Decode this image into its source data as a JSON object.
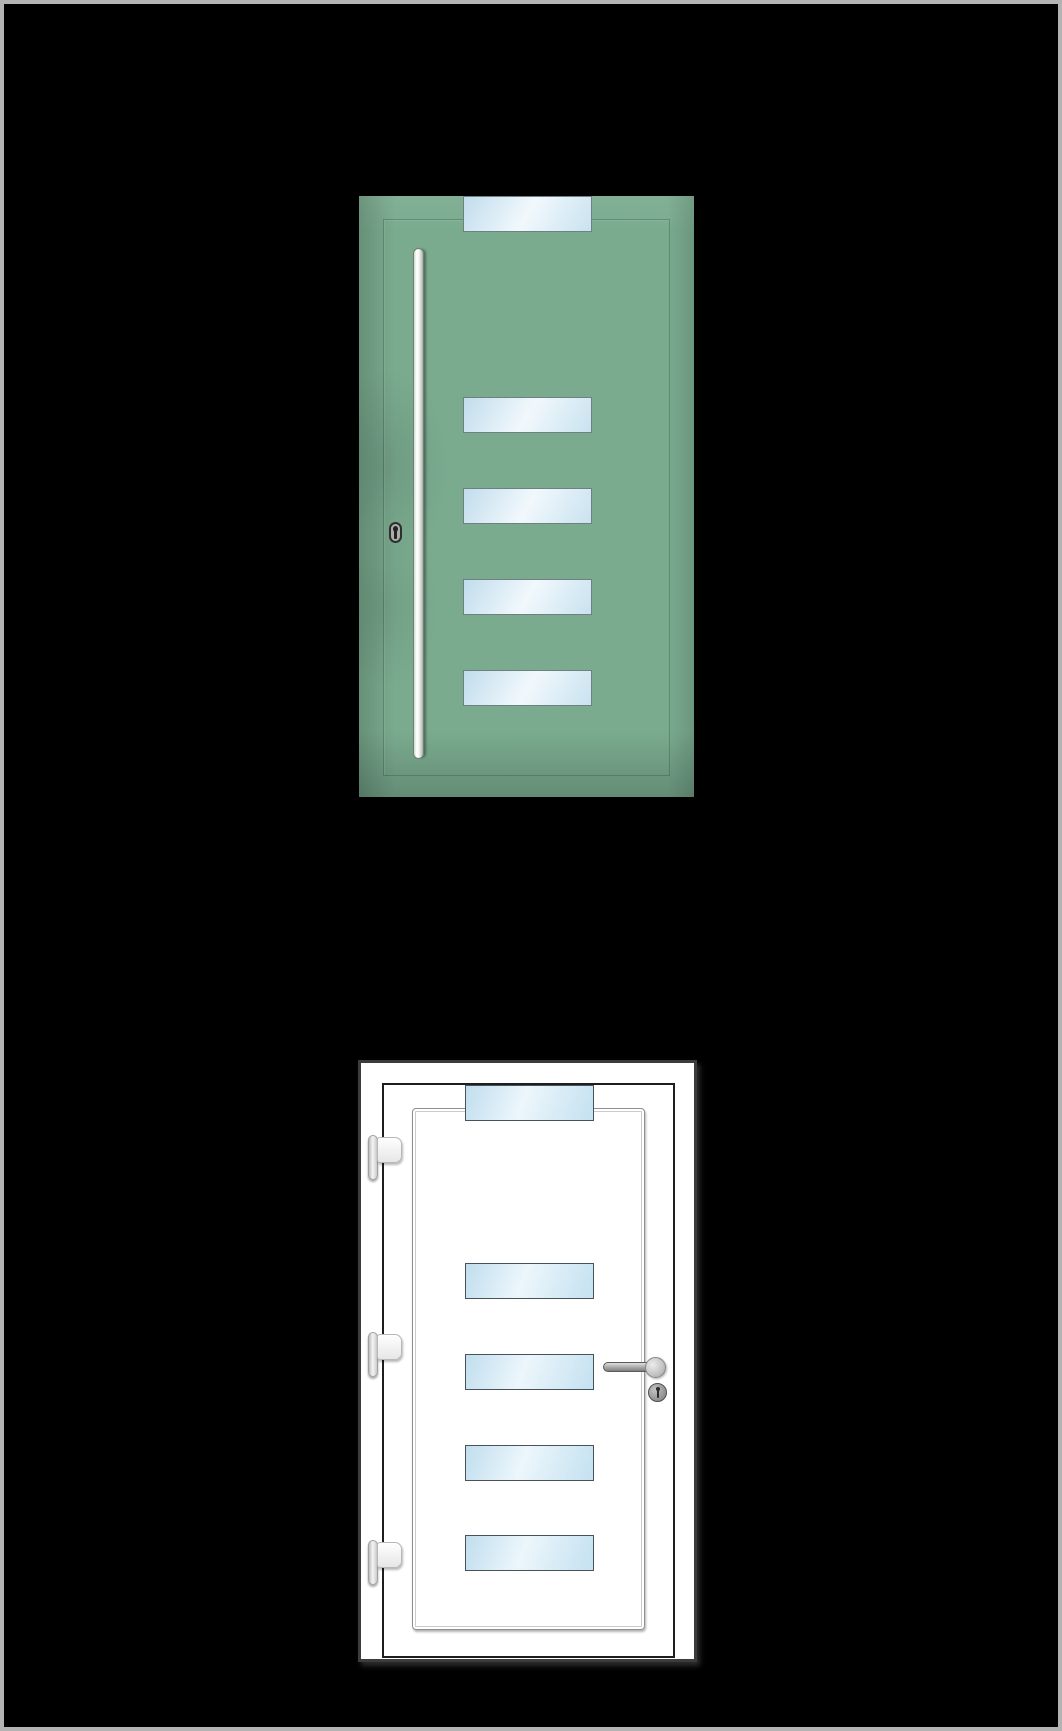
{
  "canvas": {
    "background": "#000000",
    "frame_border_color": "#b3b3b3"
  },
  "green_door": {
    "description": "sage-green entry door with five horizontal glass strips, vertical bar pull handle and lock cylinder",
    "base_color": "#7aab8f",
    "glass_fill": "#dceef8",
    "glass_border": "#6f8080",
    "pane_count": 5,
    "handle_color": "#f3f5f3",
    "lock_body_color": "#a9aeab"
  },
  "white_door": {
    "description": "white uPVC entry door with five horizontal glass strips, three hinges, lever handle and lock cylinder",
    "frame_color": "#ffffff",
    "outline_color": "#3c3c3c",
    "leaf_outline_color": "#1e1e1e",
    "trim_color": "#909090",
    "glass_fill": "#d5ecf7",
    "glass_border": "#47525a",
    "pane_count": 5,
    "hinge_count": 3,
    "hardware_color": "#9e9e9e"
  }
}
